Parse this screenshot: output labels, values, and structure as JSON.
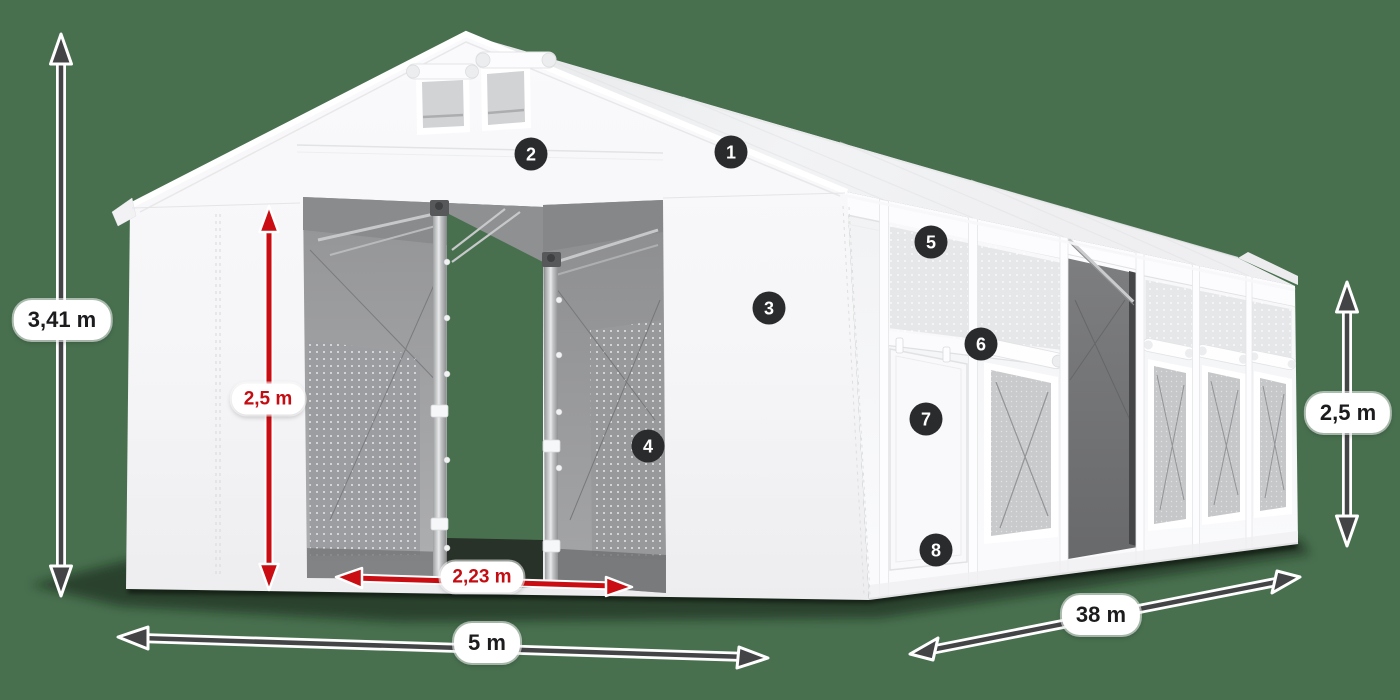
{
  "scene": {
    "type": "product-dimension-illustration",
    "subject": "white storage tent with open gates",
    "background_color": "#48704F",
    "arrow_dark_color": "#434446",
    "arrow_red_color": "#C90D12",
    "badge_color": "#2A2B2D",
    "pill_color": "#FFFFFF"
  },
  "dimension_labels": {
    "total_height": {
      "value": "3,41 m",
      "style": "black"
    },
    "front_wall_height": {
      "value": "2,5 m",
      "style": "red"
    },
    "door_width": {
      "value": "2,23 m",
      "style": "red"
    },
    "gable_width": {
      "value": "5 m",
      "style": "black"
    },
    "length": {
      "value": "38 m",
      "style": "black"
    },
    "side_wall_height": {
      "value": "2,5 m",
      "style": "black"
    }
  },
  "feature_markers": [
    {
      "number": "1"
    },
    {
      "number": "2"
    },
    {
      "number": "3"
    },
    {
      "number": "4"
    },
    {
      "number": "5"
    },
    {
      "number": "6"
    },
    {
      "number": "7"
    },
    {
      "number": "8"
    }
  ]
}
